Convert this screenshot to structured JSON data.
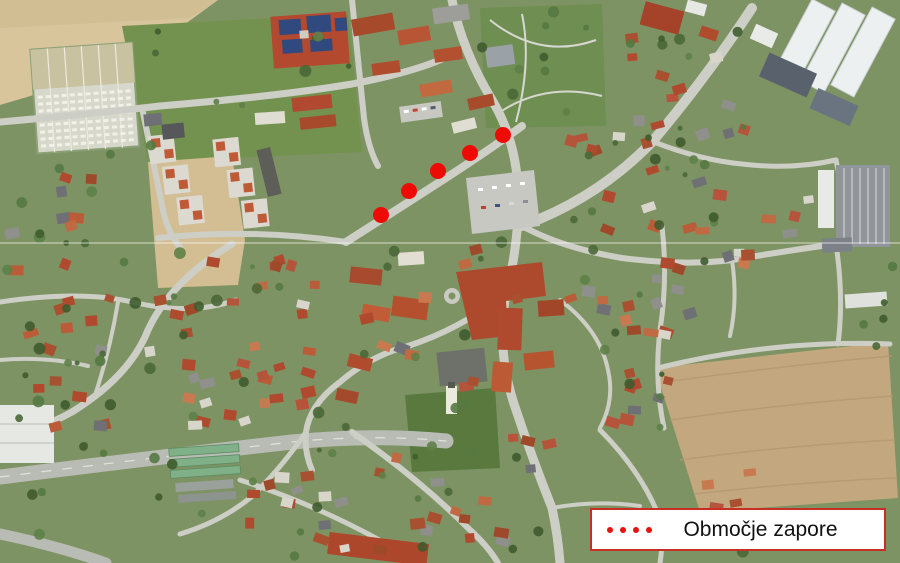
{
  "map": {
    "description": "aerial-orthophoto-town",
    "closure_markers": [
      {
        "x": 381,
        "y": 215
      },
      {
        "x": 409,
        "y": 191
      },
      {
        "x": 438,
        "y": 171
      },
      {
        "x": 470,
        "y": 153
      },
      {
        "x": 503,
        "y": 135
      }
    ],
    "marker_color": "#ee0b05",
    "marker_radius": 8,
    "seam_line_y": 243
  },
  "legend": {
    "label": "Območje zapore",
    "dot_count": 4,
    "dot_color": "#e8120e",
    "border_color": "#c62f28",
    "background_color": "#ffffff",
    "text_color": "#111111"
  }
}
